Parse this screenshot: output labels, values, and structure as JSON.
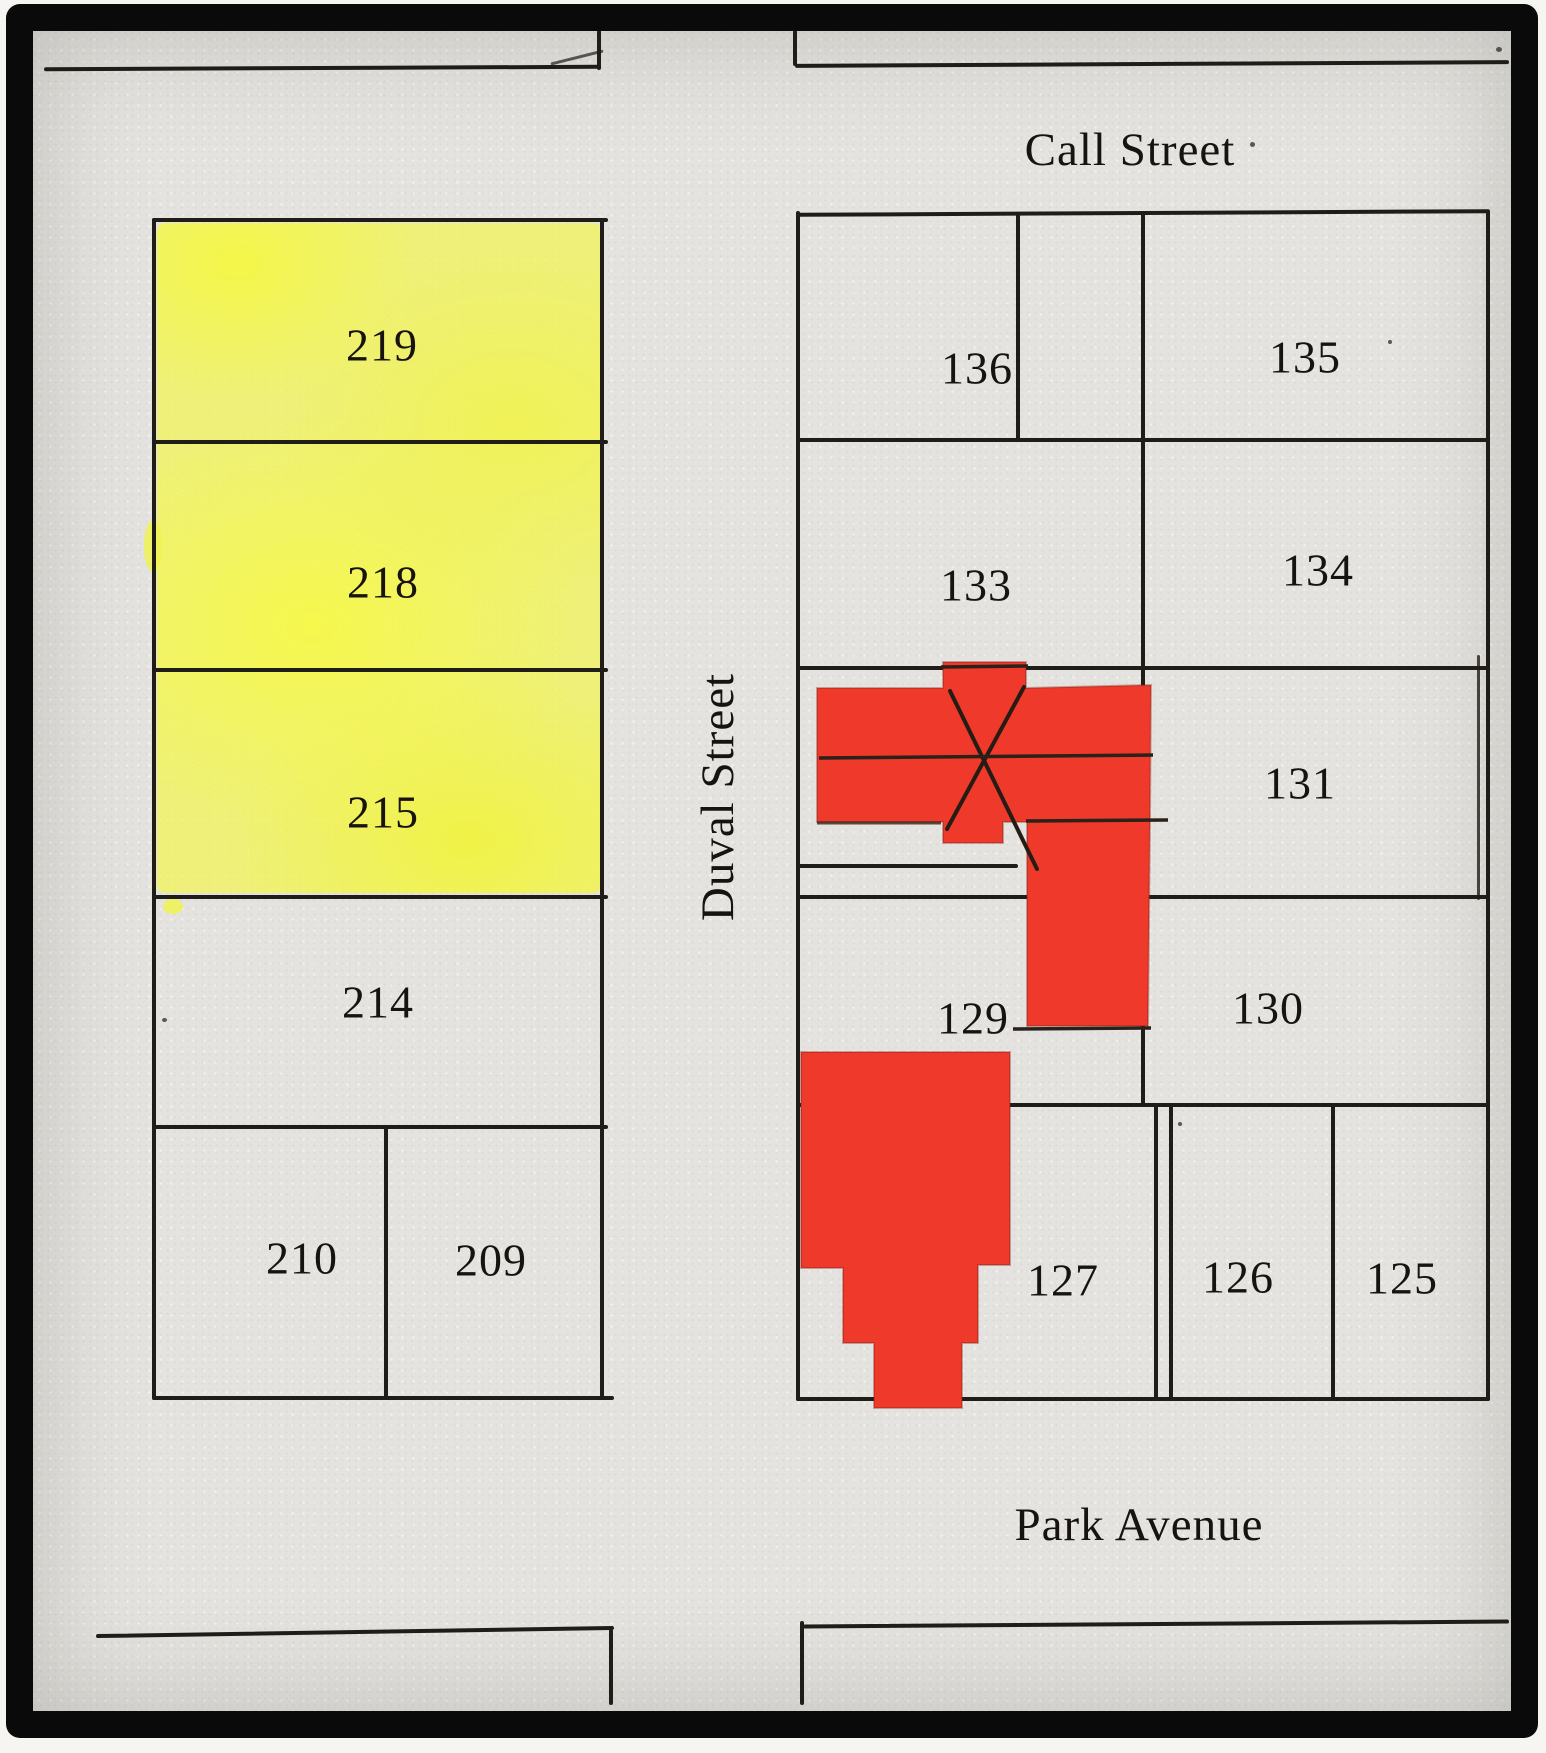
{
  "streets": {
    "call_street": "Call Street",
    "duval_street": "Duval Street",
    "park_avenue": "Park Avenue"
  },
  "left_block": {
    "name": "west-block",
    "lots": [
      {
        "number": "219",
        "highlight": "yellow"
      },
      {
        "number": "218",
        "highlight": "yellow"
      },
      {
        "number": "215",
        "highlight": "yellow"
      },
      {
        "number": "214",
        "highlight": "none"
      },
      {
        "number": "210",
        "highlight": "none"
      },
      {
        "number": "209",
        "highlight": "none"
      }
    ]
  },
  "right_block": {
    "name": "east-block",
    "lots": [
      {
        "number": "136",
        "highlight": "none"
      },
      {
        "number": "135",
        "highlight": "none"
      },
      {
        "number": "133",
        "highlight": "none"
      },
      {
        "number": "134",
        "highlight": "none"
      },
      {
        "number": "131",
        "highlight": "none"
      },
      {
        "number": "129",
        "highlight": "none"
      },
      {
        "number": "130",
        "highlight": "none"
      },
      {
        "number": "127",
        "highlight": "none"
      },
      {
        "number": "126",
        "highlight": "none"
      },
      {
        "number": "125",
        "highlight": "none"
      }
    ]
  },
  "overlays": {
    "red_building_overlays": [
      {
        "id": "upper",
        "x_annotation": true
      },
      {
        "id": "lower",
        "x_annotation": false
      }
    ]
  },
  "colors": {
    "paper": "#e4e3df",
    "ink": "#201c17",
    "frame": "#0a0a0a",
    "highlight_yellow": "#f1f15c",
    "overlay_red": "#ef392a"
  }
}
